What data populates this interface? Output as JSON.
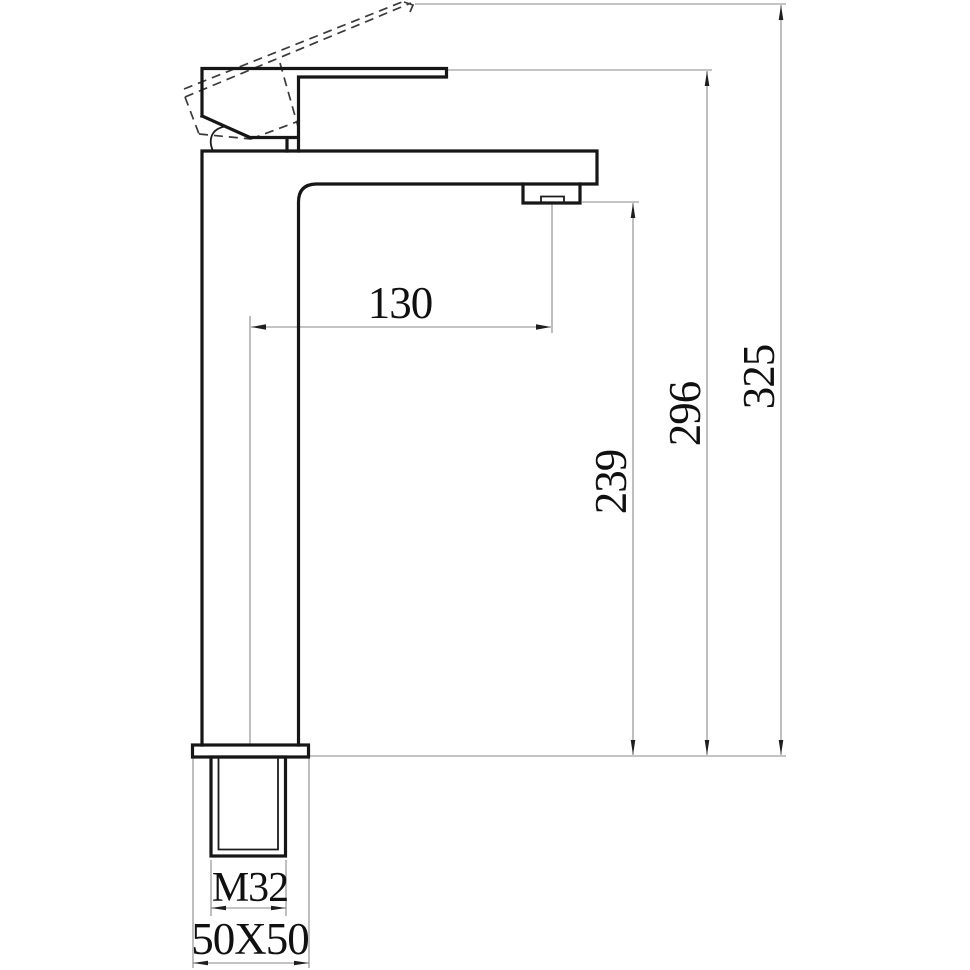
{
  "colors": {
    "background": "#ffffff",
    "part_outline": "#161616",
    "phantom_outline": "#3a3a3a",
    "dimension_lines": "#8a8a8a",
    "dimension_text": "#101010"
  },
  "dims": {
    "reach": "130",
    "outlet_height": "239",
    "handle_height": "296",
    "overall_height": "325",
    "thread": "M32",
    "base": "50X50"
  }
}
